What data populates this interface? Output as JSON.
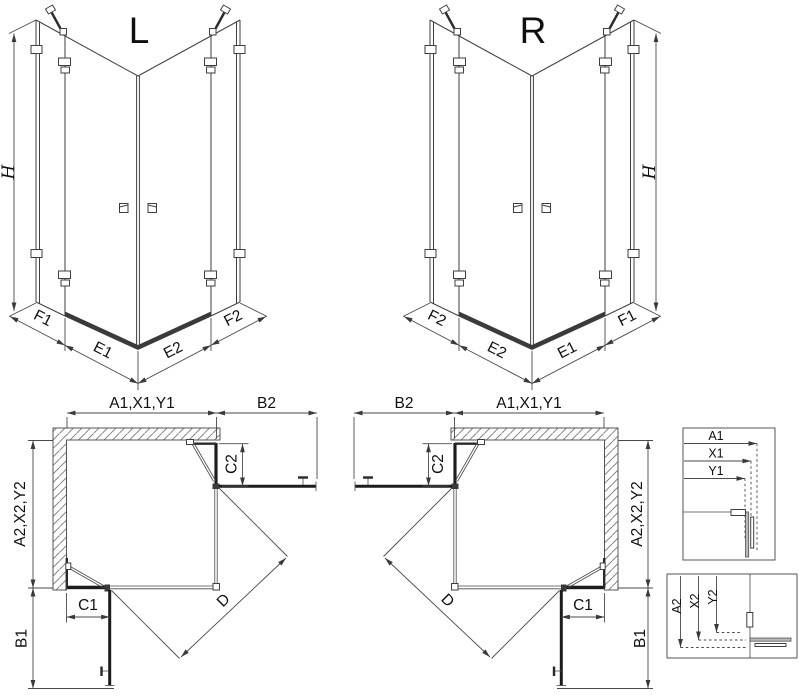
{
  "iso_left": {
    "title": "L",
    "height": "H",
    "dims": [
      "F1",
      "E1",
      "E2",
      "F2"
    ]
  },
  "iso_right": {
    "title": "R",
    "height": "H",
    "dims": [
      "F2",
      "E2",
      "E1",
      "F1"
    ]
  },
  "plan_left": {
    "width_top": "A1,X1,Y1",
    "door_top": "B2",
    "fixed_side": "C2",
    "depth_side": "A2,X2,Y2",
    "fixed_bottom": "C1",
    "door_bottom": "B1",
    "diagonal": "D"
  },
  "plan_right": {
    "width_top": "A1,X1,Y1",
    "door_top": "B2",
    "fixed_side": "C2",
    "depth_side": "A2,X2,Y2",
    "fixed_bottom": "C1",
    "door_bottom": "B1",
    "diagonal": "D"
  },
  "detail_top": {
    "labels": [
      "A1",
      "X1",
      "Y1"
    ]
  },
  "detail_bottom": {
    "labels": [
      "A2",
      "X2",
      "Y2"
    ]
  },
  "colors": {
    "line": "#3f3f3f",
    "dark": "#1c1c1c",
    "dimension": "#4a4a4a",
    "background": "#ffffff"
  }
}
